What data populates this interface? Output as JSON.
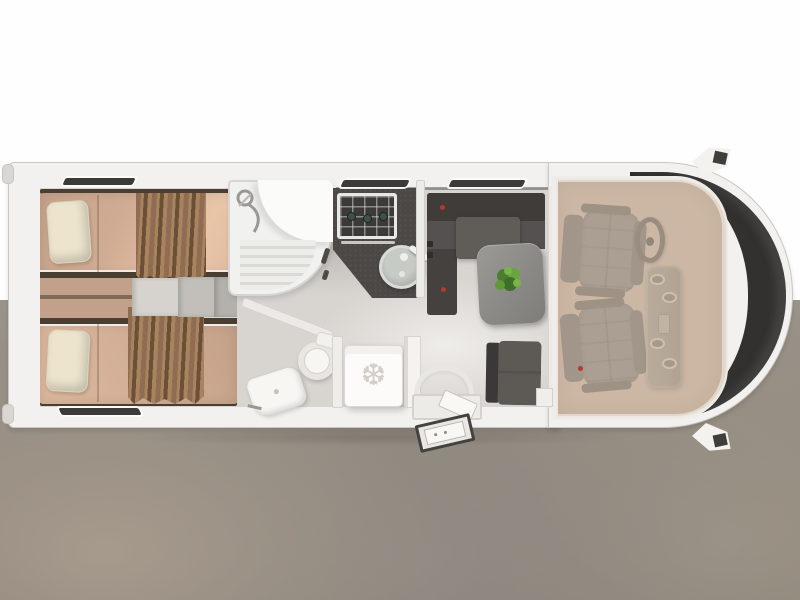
{
  "floorplan": {
    "subject": "motorhome-floor-plan",
    "view": "top-down-3d-rendering",
    "zones": [
      {
        "name": "rear-bedroom-twin-beds"
      },
      {
        "name": "shower-cabin"
      },
      {
        "name": "kitchen-hob-and-sink"
      },
      {
        "name": "washroom-toilet-and-basin"
      },
      {
        "name": "refrigerator"
      },
      {
        "name": "dinette-sofa-table-chair"
      },
      {
        "name": "entry-door-with-exterior-step"
      },
      {
        "name": "driver-cab-two-swivel-seats"
      }
    ],
    "inventory": {
      "beds": 2,
      "pillows": 2,
      "hob_burners": 3,
      "cab_seats": 2,
      "dinette_plant": 1
    }
  },
  "icons": {
    "fridge_snowflake_glyph": "❆"
  },
  "colors": {
    "band": "#fefefe",
    "wall": "#f2f1ef",
    "wall_edge": "#c9c7c4",
    "floor": "#d8d5d1",
    "window_slit": "#3c3b39",
    "bed_frame": "#4a3e33",
    "pillow": "#ece4cc",
    "curtain_a": "#8f6c52",
    "curtain_b": "#a8835f",
    "curtain_c": "#6d4f37",
    "step_a": "#d6d3ce",
    "step_b": "#c2bfba",
    "counter": "#4b4846",
    "hob_frame": "#e9e8e5",
    "hob_top": "#3b3a38",
    "burner": "#3c5245",
    "sofa": "#3f3c3a",
    "sofa_light": "#605d59",
    "accent_red": "#b23b2e",
    "white_fix": "#f7f6f3",
    "fridge": "#fcfbf9",
    "fridge_icon": "#d2cfc9",
    "step_edge": "#43423f",
    "cab_floor": "#c7b3a0",
    "cab_overlay": "rgba(209,188,169,0.45)",
    "seat": "#8d8882",
    "wheel": "#6b6660",
    "windshield": "#323130"
  }
}
